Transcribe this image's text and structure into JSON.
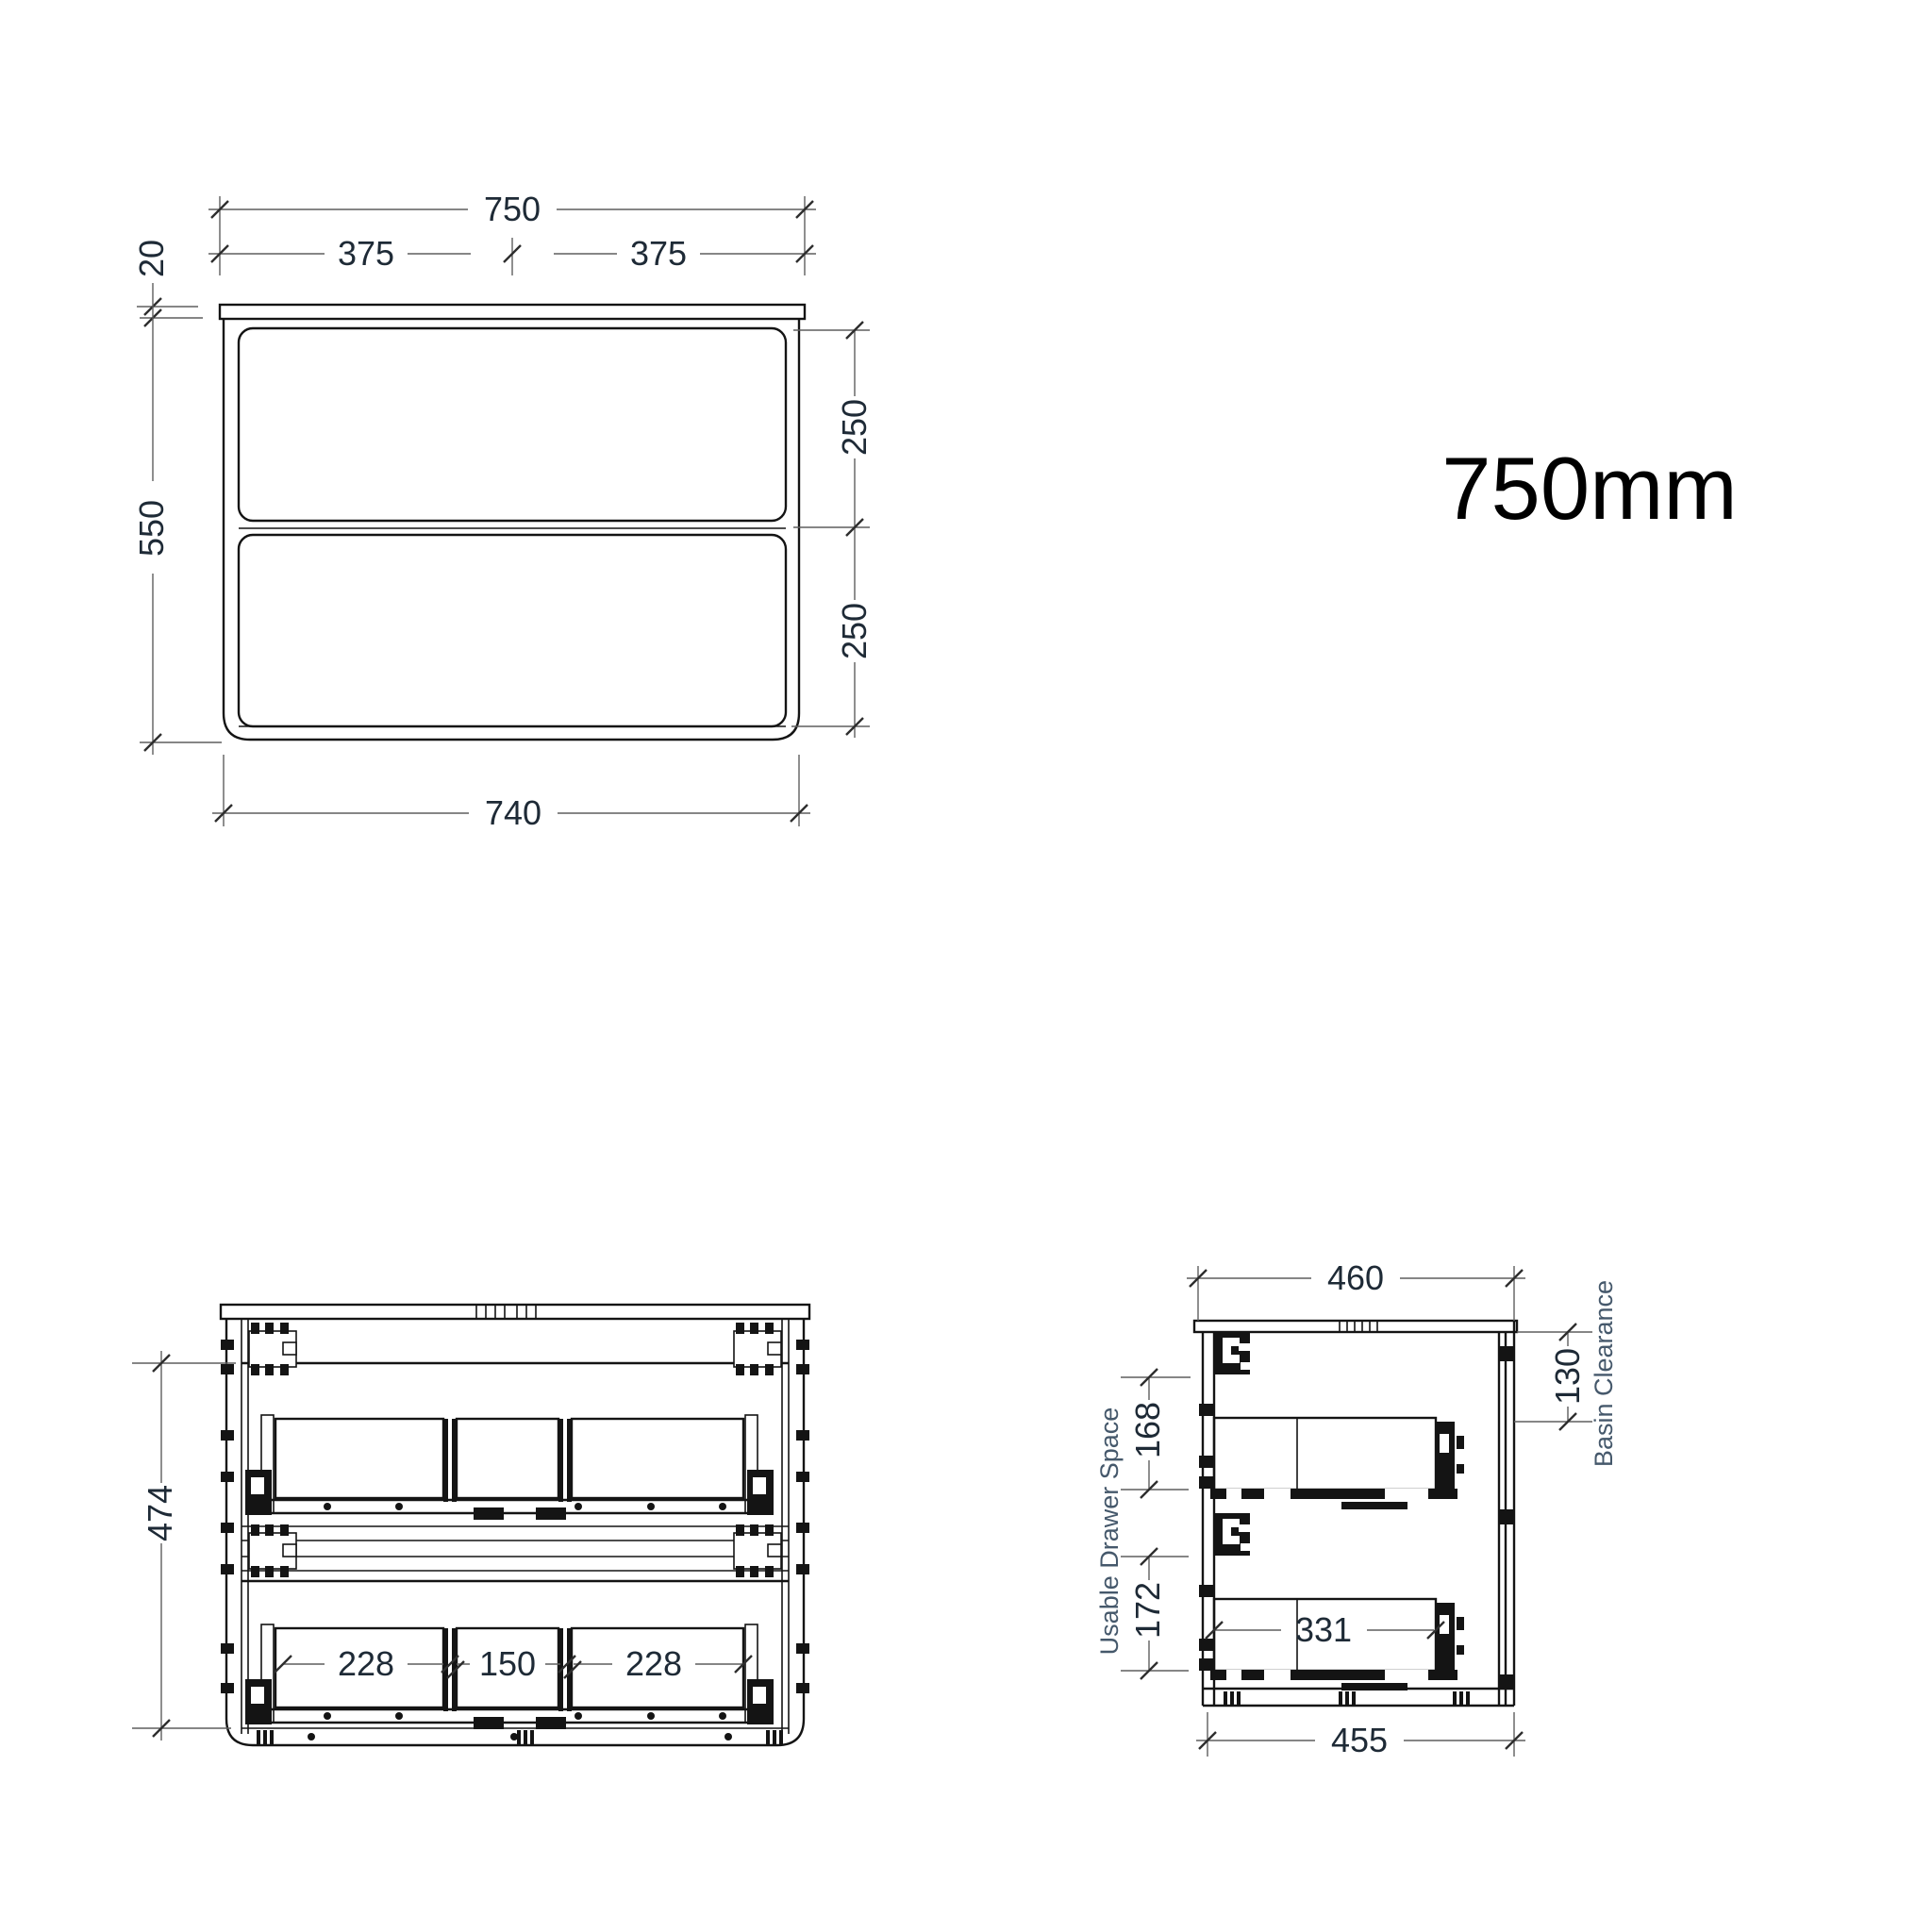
{
  "title_label": {
    "text": "750mm"
  },
  "front_view": {
    "overall_width": "750",
    "half_width_left": "375",
    "half_width_right": "375",
    "countertop_thickness": "20",
    "cabinet_height": "550",
    "top_drawer_front": "250",
    "bottom_drawer_front": "250",
    "carcass_width": "740"
  },
  "internal_view": {
    "internal_height": "474",
    "sections": [
      "228",
      "150",
      "228"
    ]
  },
  "side_view": {
    "overall_depth": "460",
    "carcass_depth": "455",
    "drawer_internal_depth": "331",
    "top_drawer_space": "168",
    "bottom_drawer_space": "172",
    "basin_clearance_value": "130",
    "basin_clearance_label": "Basin Clearance",
    "usable_drawer_space_label": "Usable Drawer Space"
  },
  "colors": {
    "background": "#ffffff",
    "line": "#141414",
    "dimension_line": "#5f5f5f",
    "dimension_text": "#1e2a36",
    "annotation_text": "#45586b"
  }
}
